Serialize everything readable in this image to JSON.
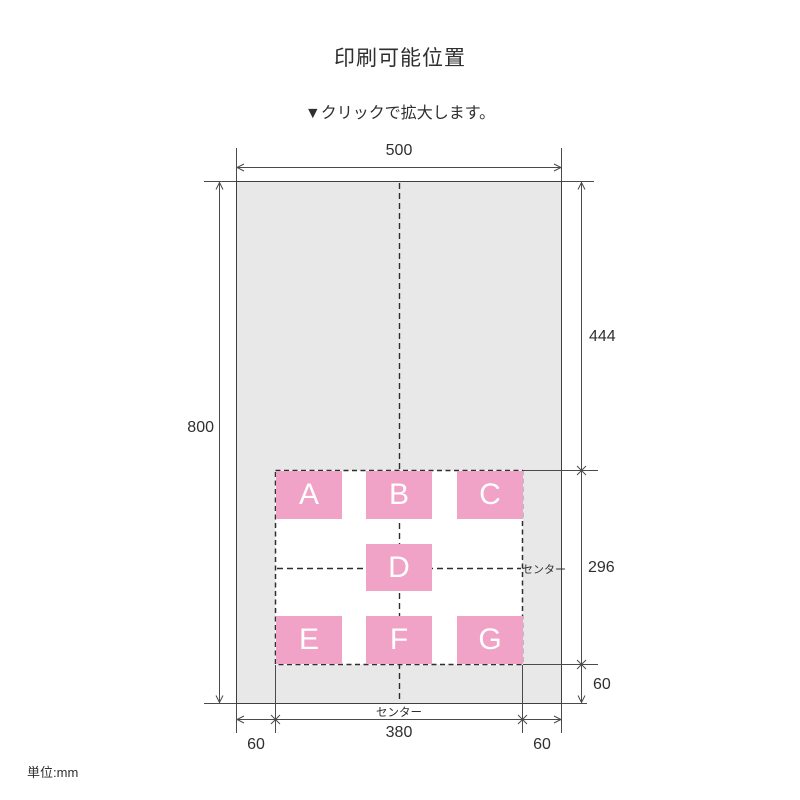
{
  "page": {
    "title": "印刷可能位置",
    "subtitle": "▼クリックで拡大します。",
    "unit_note": "単位:mm"
  },
  "colors": {
    "bag_fill": "#e8e8e8",
    "spot_fill": "#f0a2c7",
    "line_color": "#4a4a4a",
    "text_color": "#333333"
  },
  "diagram": {
    "bag_size_mm": {
      "width": 500,
      "height": 800
    },
    "print_zone_mm": {
      "width": 380,
      "height": 296,
      "offset_from_top": 444,
      "offset_from_bottom": 60,
      "offset_from_sides": 60
    },
    "dimensions": {
      "top_width": "500",
      "left_height": "800",
      "right_top": "444",
      "right_middle": "296",
      "right_bottom": "60",
      "bottom_left": "60",
      "bottom_center": "380",
      "bottom_right": "60"
    },
    "center_labels": {
      "right": "センター",
      "bottom": "センター"
    },
    "print_spots": [
      {
        "label": "A"
      },
      {
        "label": "B"
      },
      {
        "label": "C"
      },
      {
        "label": "D"
      },
      {
        "label": "E"
      },
      {
        "label": "F"
      },
      {
        "label": "G"
      }
    ]
  }
}
